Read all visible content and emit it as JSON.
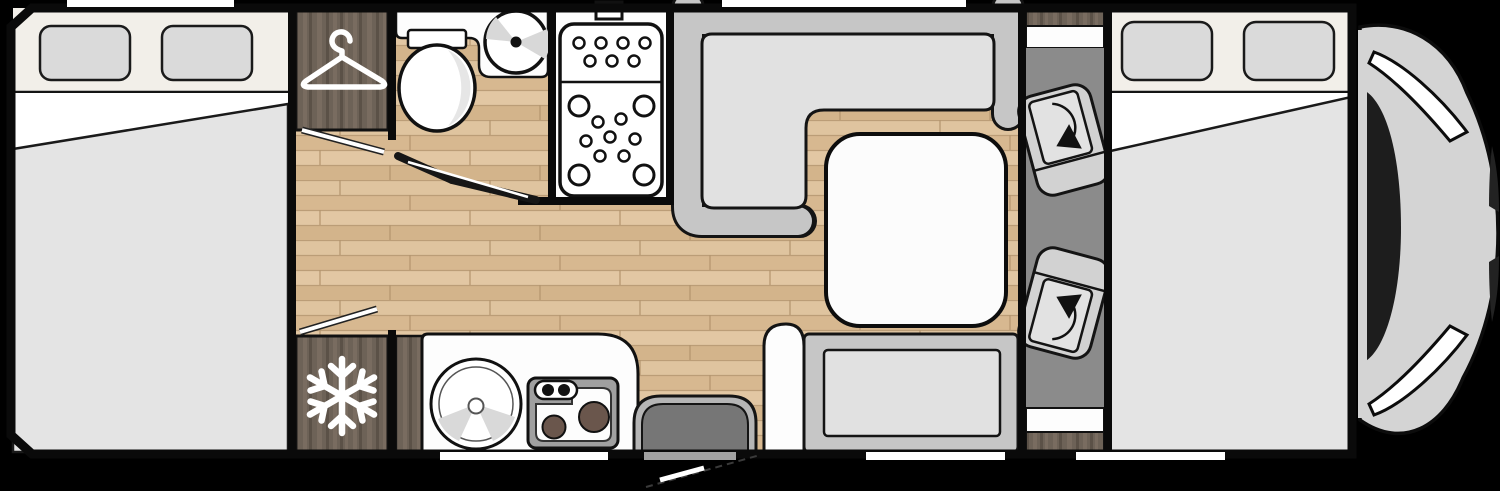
{
  "diagram": {
    "kind": "motorhome-floorplan",
    "orientation": "side-top-view, vehicle front on right",
    "rooms": [
      {
        "name": "rear-bedroom",
        "features": [
          "double-bed",
          "window-left-1",
          "window-left-2",
          "rooflight"
        ]
      },
      {
        "name": "wardrobe",
        "icon": "hanger-icon"
      },
      {
        "name": "fridge",
        "icon": "snowflake-icon"
      },
      {
        "name": "bathroom",
        "features": [
          "toilet",
          "round-basin",
          "bifold-door"
        ]
      },
      {
        "name": "shower",
        "features": [
          "shower-tray",
          "drain-dots",
          "shower-head-mount"
        ]
      },
      {
        "name": "dinette",
        "features": [
          "l-shaped-sofa",
          "table",
          "rooflight"
        ]
      },
      {
        "name": "travel-bench",
        "features": [
          "bench-seat",
          "armrest"
        ]
      },
      {
        "name": "kitchen",
        "features": [
          "round-sink",
          "two-burner-hob",
          "cabinet"
        ]
      },
      {
        "name": "entrance",
        "features": [
          "door-mat",
          "door-swing"
        ]
      },
      {
        "name": "cab",
        "features": [
          "driver-swivel-seat",
          "passenger-swivel-seat",
          "rotation-arrow-icon"
        ]
      },
      {
        "name": "front-bedroom",
        "features": [
          "drop-down-bed",
          "window-right-1",
          "window-right-2"
        ]
      },
      {
        "name": "vehicle-nose",
        "features": [
          "windshield",
          "hood",
          "a-pillar-slivers"
        ]
      }
    ],
    "counts": {
      "windows": 4,
      "roof_openings_top": 2,
      "wall_openings_bottom": 3,
      "swivel_seats": 2,
      "burners": 2
    }
  },
  "colors": {
    "background": "#000000",
    "wall": "#0a0a0a",
    "interior": "#fdfdfd",
    "window_band": "#f2efe9",
    "window_glass": "#dadada",
    "bed_blanket": "#e4e4e4",
    "sofa_back": "#c6c6c6",
    "sofa_cushion": "#e1e1e1",
    "table_top": "#fcfcfc",
    "cab_floor": "#8b8b8b",
    "seat_body": "#d2d2d2",
    "seat_inner": "#e2e2e2",
    "mat_outer": "#b5b5b5",
    "mat_inner": "#767676",
    "stove_body": "#a0a0a0",
    "burner": "#6a564c",
    "nose_body": "#d4d4d4",
    "windshield": "#1d1d1d",
    "door_leaf": "#ffffff",
    "icon": "#ffffff",
    "wood_base": "#dfc49f",
    "dark_wood": "#6d6257",
    "opening_gray": "#a2a2a2"
  }
}
